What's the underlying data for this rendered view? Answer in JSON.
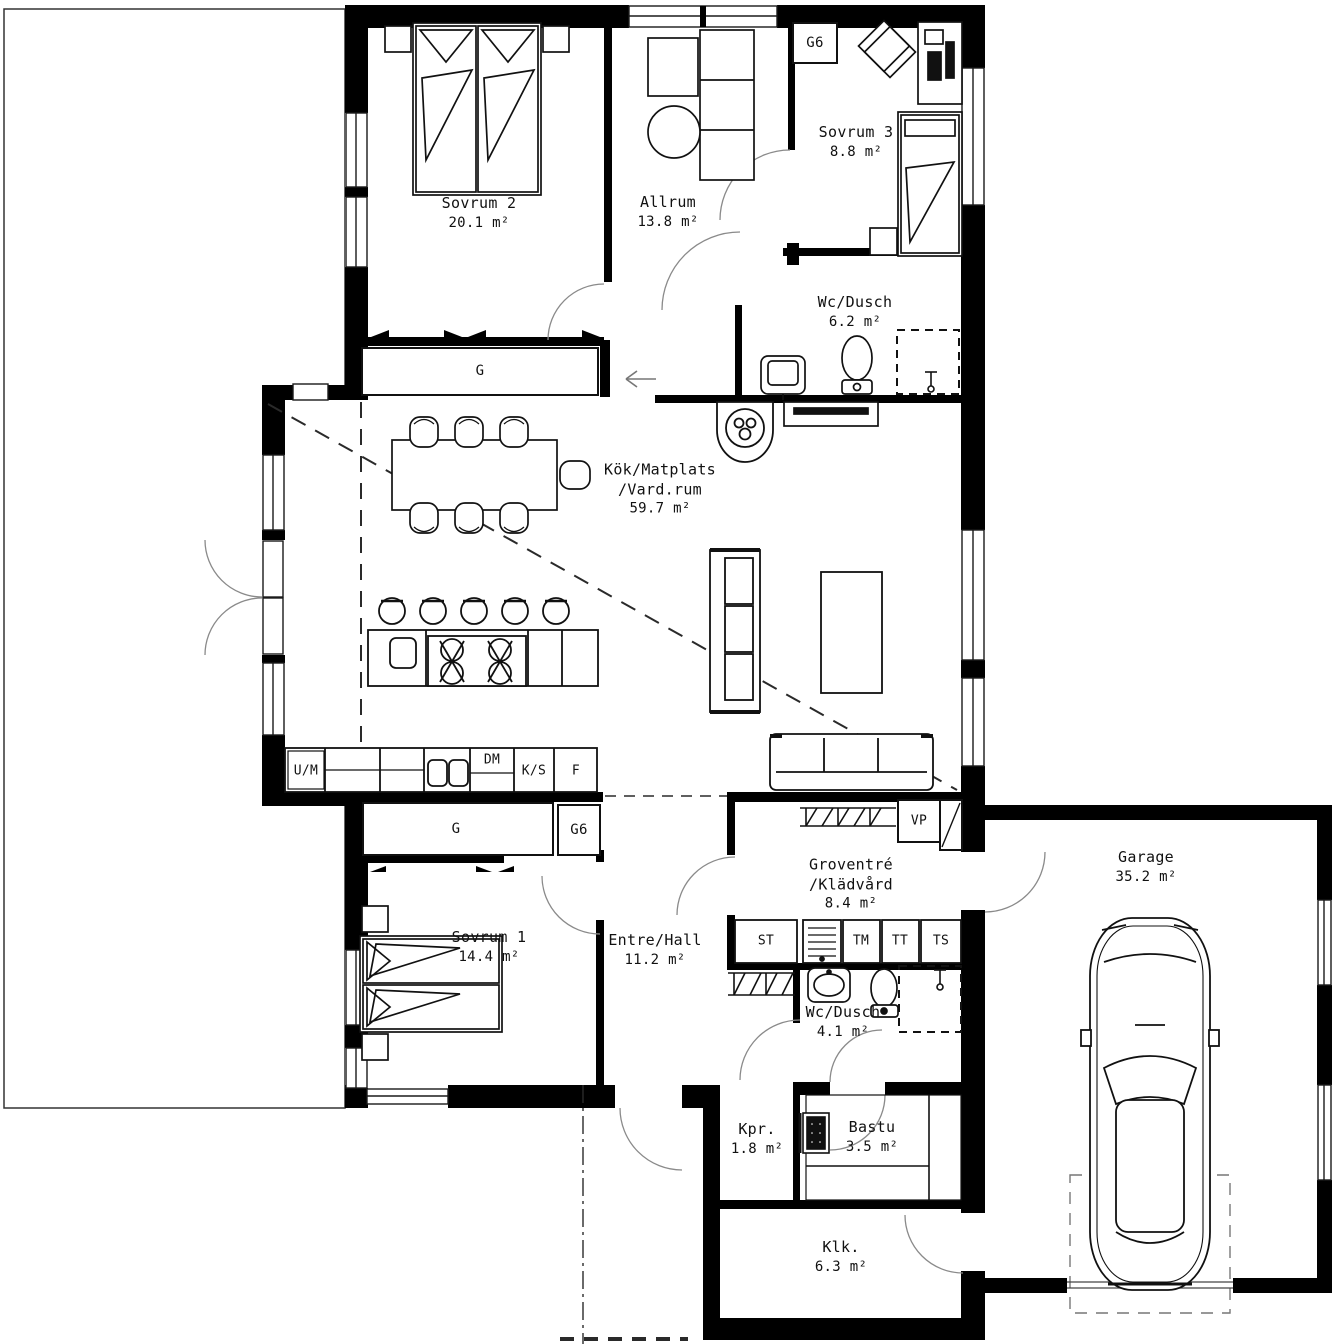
{
  "plan_title": "House floor plan",
  "rooms": [
    {
      "name": "Sovrum 2",
      "area": "20.1 m²"
    },
    {
      "name": "Allrum",
      "area": "13.8 m²"
    },
    {
      "name": "Sovrum 3",
      "area": "8.8 m²"
    },
    {
      "name": "Wc/Dusch",
      "area": "6.2 m²"
    },
    {
      "name": "Kök/Matplats",
      "name2": "/Vard.rum",
      "area": "59.7 m²"
    },
    {
      "name": "Sovrum 1",
      "area": "14.4 m²"
    },
    {
      "name": "Entre/Hall",
      "area": "11.2 m²"
    },
    {
      "name": "Groventré",
      "name2": "/Klädvård",
      "area": "8.4 m²"
    },
    {
      "name": "Wc/Dusch",
      "area": "4.1 m²"
    },
    {
      "name": "Kpr.",
      "area": "1.8 m²"
    },
    {
      "name": "Bastu",
      "area": "3.5 m²"
    },
    {
      "name": "Klk.",
      "area": "6.3 m²"
    },
    {
      "name": "Garage",
      "area": "35.2 m²"
    }
  ],
  "closets": {
    "g_upper": "G",
    "g_lower": "G",
    "g6_bedroom": "G6",
    "g6_hall": "G6"
  },
  "kitchen_units": {
    "um": "U/M",
    "dm": "DM",
    "ks": "K/S",
    "f": "F"
  },
  "utility_units": {
    "vp": "VP",
    "st": "ST",
    "tm": "TM",
    "tt": "TT",
    "ts": "TS"
  },
  "colors": {
    "wall": "#000000",
    "line": "#141414",
    "background": "#ffffff"
  }
}
